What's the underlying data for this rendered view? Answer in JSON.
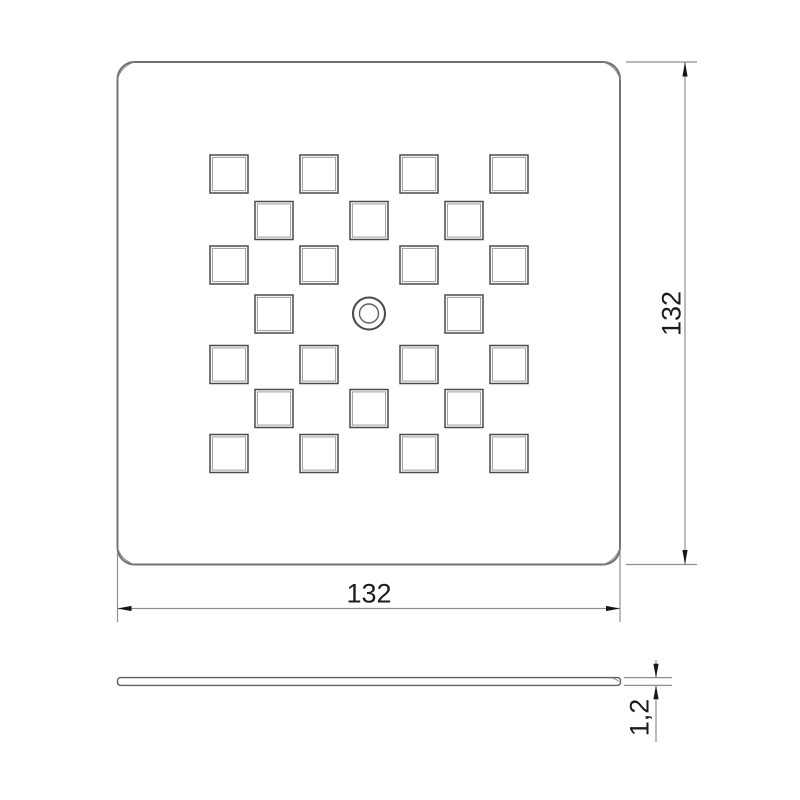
{
  "drawing": {
    "type": "technical-drawing",
    "part_name": "perforated-square-plate",
    "views": {
      "front": {
        "plate": {
          "x": 117.5,
          "y": 62,
          "size": 502.5,
          "corner_radius": 17,
          "corner_inner_arc_radius": 24.5
        },
        "square_holes": {
          "size": 38,
          "inner_line_inset": 2.4,
          "count": 24,
          "centers": [
            [
              229,
              174
            ],
            [
              319,
              174
            ],
            [
              419,
              174
            ],
            [
              509,
              174
            ],
            [
              274,
              220.5
            ],
            [
              369,
              220.5
            ],
            [
              464,
              220.5
            ],
            [
              229,
              265
            ],
            [
              319,
              265
            ],
            [
              419,
              265
            ],
            [
              509,
              265
            ],
            [
              274,
              314
            ],
            [
              464,
              314
            ],
            [
              229,
              364.5
            ],
            [
              319,
              364.5
            ],
            [
              419,
              364.5
            ],
            [
              509,
              364.5
            ],
            [
              274,
              408.5
            ],
            [
              369,
              408.5
            ],
            [
              464,
              408.5
            ],
            [
              229,
              453.5
            ],
            [
              319,
              453.5
            ],
            [
              419,
              453.5
            ],
            [
              509,
              453.5
            ]
          ]
        },
        "center_hole": {
          "cx": 369,
          "cy": 313.5,
          "r_outer": 16,
          "r_inner": 9.5
        }
      },
      "side": {
        "x": 117.5,
        "y": 677.6,
        "length": 503,
        "thickness": 7.8,
        "corner_radius": 3
      }
    },
    "dimensions": {
      "height": {
        "label": "132",
        "orientation": "vertical"
      },
      "width": {
        "label": "132",
        "orientation": "horizontal"
      },
      "thickness": {
        "label": "1,2",
        "orientation": "vertical"
      }
    },
    "colors": {
      "background": "#ffffff",
      "outline": "#6f6f6f",
      "corner_line": "#8a8a8a",
      "hole_line": "#4a4a4a",
      "hole_inner_line": "#9c9c9c",
      "dim_line": "#8f8f8f",
      "arrow": "#161616",
      "text": "#1c1c1c"
    }
  }
}
